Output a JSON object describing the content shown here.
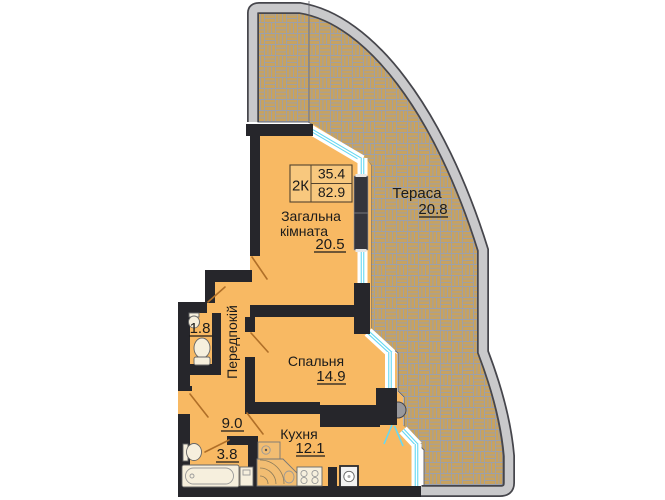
{
  "plan": {
    "info_box": {
      "type_label": "2К",
      "living_area": "35.4",
      "total_area": "82.9"
    },
    "rooms": {
      "living": {
        "name_line1": "Загальна",
        "name_line2": "кімната",
        "area": "20.5"
      },
      "terrace": {
        "name": "Тераса",
        "area": "20.8"
      },
      "bedroom": {
        "name": "Спальня",
        "area": "14.9"
      },
      "kitchen": {
        "name": "Кухня",
        "area": "12.1"
      },
      "hallway": {
        "name": "Передпокій",
        "area": "9.0"
      },
      "wc": {
        "area": "1.8"
      },
      "bathroom": {
        "area": "3.8"
      }
    },
    "colors": {
      "floor": "#f8b963",
      "wall": "#26262b",
      "paving": "#c7a260",
      "paving_line": "#9ba0ac",
      "glazing": "#66d8f2",
      "outer_band": "#c9c9cb",
      "door_swing": "#b06f28",
      "text": "#1b1b1b"
    }
  }
}
